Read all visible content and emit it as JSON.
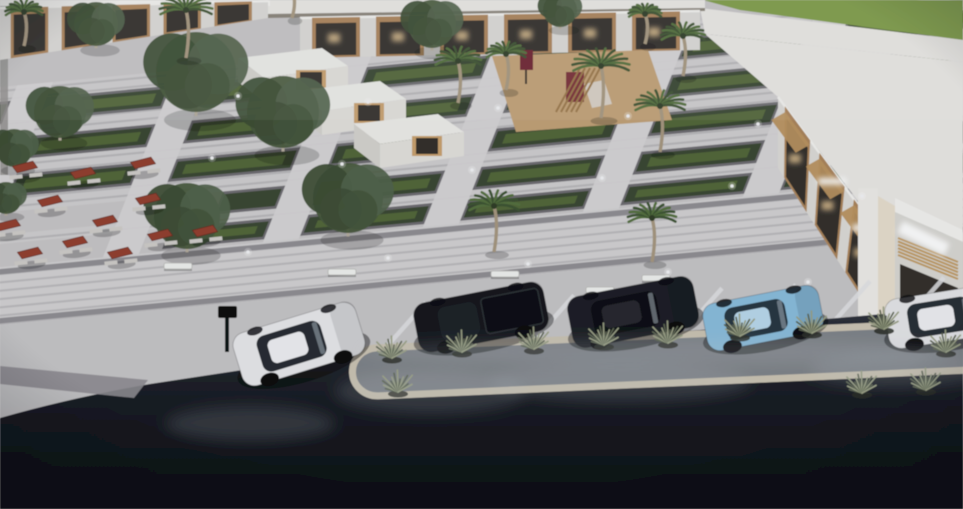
{
  "scene": {
    "description": "Aerial dusk 3D architectural rendering of a landscaped retail plaza with palm trees, picnic tables, a playground, striped walkways, and cars parked along a dark asphalt road",
    "sign_note": "glowing white storefront sign, text not legible"
  },
  "palette": {
    "pavement": "#c7c5c6",
    "pavement_light": "#d6d4d5",
    "pavement_dark": "#908e92",
    "planter_border": "#6e6c70",
    "hedge": "#3a4730",
    "grass": "#546739",
    "field": "#7f9c49",
    "building_face": "#dcdad5",
    "roof": "#e9e7e3",
    "parapet": "#f2f1ee",
    "eave": "#8a8278",
    "wood": "#ab845a",
    "wood_dark": "#7c5c3a",
    "glass_dark": "#332f2b",
    "warm_glow": "#e7c794",
    "sign_white": "#ffffff",
    "table_top": "#93402f",
    "bench": "#eff0ee",
    "curb": "#cbc2b1",
    "island_fill": "#7e8287",
    "tuft_light": "#9aa083",
    "tuft_dark": "#5c6450",
    "playground_sand": "#c1a175",
    "play_equipment": "#7a2f38",
    "play_wood": "#9a7648",
    "asphalt_top": "#2e313a",
    "asphalt_bottom": "#0b0d12",
    "stripe_white": "#e2e2e4"
  },
  "grid": {
    "matrix": [
      1,
      -0.095,
      -0.38,
      0.96,
      95,
      78
    ],
    "u_range": [
      -150,
      1030
    ],
    "walk_rows": [
      [
        0,
        16
      ],
      [
        40,
        56
      ],
      [
        80,
        96
      ],
      [
        120,
        136
      ],
      [
        160,
        170
      ]
    ],
    "planter_rows": [
      {
        "v": [
          16,
          40
        ],
        "u_min": -150
      },
      {
        "v": [
          56,
          80
        ],
        "u_min": -150
      },
      {
        "v": [
          96,
          120
        ],
        "u_min": -150
      },
      {
        "v": [
          136,
          160
        ],
        "u_min": 180
      },
      {
        "v": [
          170,
          192
        ],
        "u_min": 140
      }
    ],
    "cross_u": [
      -60,
      100,
      260,
      420,
      580,
      740,
      900
    ],
    "cross_half": 18,
    "promenade_v": [
      195,
      258
    ],
    "apron_v": [
      258,
      348
    ]
  },
  "buildings": {
    "grass_field": [
      [
        703,
        0
      ],
      [
        963,
        0
      ],
      [
        963,
        40
      ],
      [
        740,
        10
      ]
    ],
    "roofs": [
      [
        [
          268,
          0
        ],
        [
          705,
          0
        ],
        [
          705,
          8
        ],
        [
          268,
          14
        ]
      ],
      [
        [
          700,
          8
        ],
        [
          963,
          40
        ],
        [
          963,
          62
        ],
        [
          705,
          34
        ]
      ],
      [
        [
          705,
          34
        ],
        [
          963,
          62
        ],
        [
          963,
          150
        ],
        [
          902,
          258
        ],
        [
          778,
          97
        ]
      ],
      [
        [
          880,
          140
        ],
        [
          963,
          152
        ],
        [
          963,
          232
        ],
        [
          896,
          206
        ]
      ]
    ],
    "eave": [
      [
        268,
        14
      ],
      [
        705,
        8
      ],
      [
        705,
        11
      ],
      [
        268,
        18
      ]
    ],
    "top_left_row": {
      "top": [
        [
          0,
          8
        ],
        [
          268,
          1
        ]
      ],
      "bottom": [
        [
          0,
          60
        ],
        [
          268,
          18
        ]
      ],
      "units": [
        [
          0.04,
          0.18
        ],
        [
          0.23,
          0.37
        ],
        [
          0.42,
          0.56
        ],
        [
          0.61,
          0.75
        ],
        [
          0.8,
          0.94
        ]
      ],
      "lit": false,
      "awning": false,
      "signs": []
    },
    "top_center_row": {
      "top": [
        [
          300,
          18
        ],
        [
          700,
          11
        ]
      ],
      "bottom": [
        [
          300,
          58
        ],
        [
          700,
          50
        ]
      ],
      "units": [
        [
          0.03,
          0.15
        ],
        [
          0.19,
          0.31
        ],
        [
          0.35,
          0.47
        ],
        [
          0.51,
          0.63
        ],
        [
          0.67,
          0.79
        ],
        [
          0.83,
          0.95
        ]
      ],
      "lit": true,
      "awning": false,
      "signs": []
    },
    "right_row": {
      "top": [
        [
          778,
          97
        ],
        [
          893,
          252
        ]
      ],
      "bottom": [
        [
          778,
          168
        ],
        [
          880,
          326
        ]
      ],
      "units": [
        [
          0.06,
          0.28
        ],
        [
          0.36,
          0.58
        ],
        [
          0.66,
          0.88
        ]
      ],
      "lit": true,
      "awning": true,
      "signs": [
        1,
        2
      ]
    },
    "far_right": {
      "pillar": [
        [
          878,
          196
        ],
        [
          895,
          206
        ],
        [
          895,
          332
        ],
        [
          878,
          318
        ]
      ],
      "column": [
        858,
        188,
        20,
        132
      ],
      "parapet": [
        [
          895,
          198
        ],
        [
          963,
          230
        ],
        [
          963,
          242
        ],
        [
          895,
          212
        ]
      ],
      "face": [
        [
          895,
          212
        ],
        [
          963,
          242
        ],
        [
          963,
          360
        ],
        [
          895,
          332
        ]
      ],
      "glass": [
        [
          900,
          264
        ],
        [
          958,
          288
        ],
        [
          958,
          334
        ],
        [
          900,
          312
        ]
      ],
      "sign": {
        "x": 903,
        "y": 221,
        "w": 52,
        "h": 13,
        "rot": 26
      },
      "slats": {
        "x1": 898,
        "y1": 238,
        "x2": 958,
        "y2": 262,
        "count": 6,
        "step": 3.4
      },
      "windows": [
        [
          912,
          296,
          16,
          24
        ],
        [
          938,
          306,
          15,
          22
        ]
      ]
    },
    "kiosks": [
      [
        238,
        58
      ],
      [
        296,
        91
      ],
      [
        354,
        124
      ]
    ]
  },
  "playground": {
    "patch": [
      [
        492,
        56
      ],
      [
        648,
        50
      ],
      [
        672,
        120
      ],
      [
        516,
        132
      ]
    ],
    "board": [
      520,
      50,
      13,
      20
    ],
    "tower": [
      566,
      72,
      18,
      30
    ],
    "slide": [
      [
        584,
        84
      ],
      [
        604,
        80
      ],
      [
        612,
        104
      ],
      [
        592,
        108
      ]
    ],
    "ladder": [
      [
        556,
        112
      ],
      [
        580,
        68
      ]
    ]
  },
  "vegetation": {
    "palms": [
      {
        "x": 186,
        "y": 58,
        "h": 48
      },
      {
        "x": 24,
        "y": 46,
        "h": 34
      },
      {
        "x": 292,
        "y": 18,
        "h": 28
      },
      {
        "x": 458,
        "y": 103,
        "h": 42
      },
      {
        "x": 506,
        "y": 90,
        "h": 36
      },
      {
        "x": 601,
        "y": 118,
        "h": 52
      },
      {
        "x": 645,
        "y": 44,
        "h": 30
      },
      {
        "x": 683,
        "y": 76,
        "h": 40
      },
      {
        "x": 660,
        "y": 152,
        "h": 46
      },
      {
        "x": 494,
        "y": 252,
        "h": 46
      },
      {
        "x": 652,
        "y": 262,
        "h": 44
      }
    ],
    "trees": [
      {
        "x": 60,
        "y": 112,
        "r": 26
      },
      {
        "x": 14,
        "y": 148,
        "r": 19
      },
      {
        "x": 96,
        "y": 24,
        "r": 22
      },
      {
        "x": 196,
        "y": 72,
        "r": 40
      },
      {
        "x": 283,
        "y": 112,
        "r": 36
      },
      {
        "x": 187,
        "y": 216,
        "r": 33
      },
      {
        "x": 348,
        "y": 198,
        "r": 35
      },
      {
        "x": 432,
        "y": 24,
        "r": 24
      },
      {
        "x": 6,
        "y": 198,
        "r": 16
      },
      {
        "x": 560,
        "y": 10,
        "r": 17
      }
    ],
    "tufts": [
      [
        392,
        358
      ],
      [
        462,
        352
      ],
      [
        534,
        349
      ],
      [
        604,
        345
      ],
      [
        668,
        343
      ],
      [
        740,
        336
      ],
      [
        812,
        333
      ],
      [
        884,
        329
      ],
      [
        946,
        352
      ],
      [
        926,
        390
      ],
      [
        862,
        393
      ],
      [
        398,
        392
      ]
    ]
  },
  "furniture": {
    "tables": [
      [
        25,
        172
      ],
      [
        83,
        178
      ],
      [
        143,
        168
      ],
      [
        50,
        206
      ],
      [
        148,
        204
      ],
      [
        8,
        230
      ],
      [
        105,
        226
      ],
      [
        75,
        247
      ],
      [
        160,
        240
      ],
      [
        205,
        236
      ],
      [
        30,
        258
      ],
      [
        120,
        258
      ]
    ],
    "benches": [
      [
        178,
        266
      ],
      [
        342,
        272
      ],
      [
        505,
        274
      ],
      [
        656,
        278
      ],
      [
        600,
        290
      ]
    ],
    "bollards": [
      [
        238,
        96
      ],
      [
        368,
        102
      ],
      [
        498,
        108
      ],
      [
        628,
        116
      ],
      [
        758,
        124
      ],
      [
        212,
        158
      ],
      [
        342,
        164
      ],
      [
        472,
        170
      ],
      [
        602,
        178
      ],
      [
        732,
        186
      ],
      [
        862,
        196
      ],
      [
        248,
        252
      ],
      [
        388,
        258
      ],
      [
        528,
        264
      ],
      [
        668,
        272
      ],
      [
        808,
        282
      ]
    ],
    "post": {
      "x": 218,
      "y": 306,
      "w": 19,
      "h": 12,
      "pole_h": 34
    }
  },
  "road": {
    "boundary": "M0,418 Q70,398 150,384 L360,352 L700,330 L963,307 L963,509 L0,509 Z",
    "crosswalk": [
      [
        0,
        366
      ],
      [
        148,
        380
      ],
      [
        134,
        398
      ],
      [
        0,
        384
      ]
    ],
    "stripe_x": [
      352,
      426,
      500,
      574,
      648,
      722,
      796,
      870,
      944
    ],
    "island": {
      "x": 352,
      "y": 336,
      "w": 640,
      "h": 48,
      "rx": 25,
      "rot": -2.5,
      "cx": 650,
      "cy": 355
    },
    "smoke": [
      [
        430,
        392,
        95,
        22
      ],
      [
        620,
        382,
        130,
        20
      ],
      [
        250,
        424,
        85,
        18
      ],
      [
        660,
        352,
        300,
        13
      ],
      [
        900,
        370,
        90,
        18
      ]
    ]
  },
  "cars": [
    {
      "name": "white-suv",
      "cx": 299,
      "cy": 344,
      "len": 128,
      "wid": 55,
      "angle": -17,
      "body": "#e7e7e9",
      "glass": "#262b31",
      "roof": "#eeeef1",
      "type": "suv"
    },
    {
      "name": "black-pickup",
      "cx": 481,
      "cy": 317,
      "len": 132,
      "wid": 50,
      "angle": -11,
      "body": "#17191e",
      "glass": "#1d2228",
      "roof": "#1f2126",
      "type": "pickup"
    },
    {
      "name": "black-suv",
      "cx": 633,
      "cy": 312,
      "len": 128,
      "wid": 52,
      "angle": -11,
      "body": "#1d1f24",
      "glass": "#0f1013",
      "roof": "#26282d",
      "type": "suv"
    },
    {
      "name": "blue-crossover",
      "cx": 763,
      "cy": 318,
      "len": 118,
      "wid": 48,
      "angle": -11,
      "body": "#8abcdb",
      "glass": "#263541",
      "roof": "#b9d7ea",
      "type": "suv"
    },
    {
      "name": "white-suv-edge",
      "cx": 947,
      "cy": 316,
      "len": 122,
      "wid": 50,
      "angle": -9,
      "body": "#e4e4e6",
      "glass": "#2a2e34",
      "roof": "#ededf0",
      "type": "suv"
    }
  ]
}
